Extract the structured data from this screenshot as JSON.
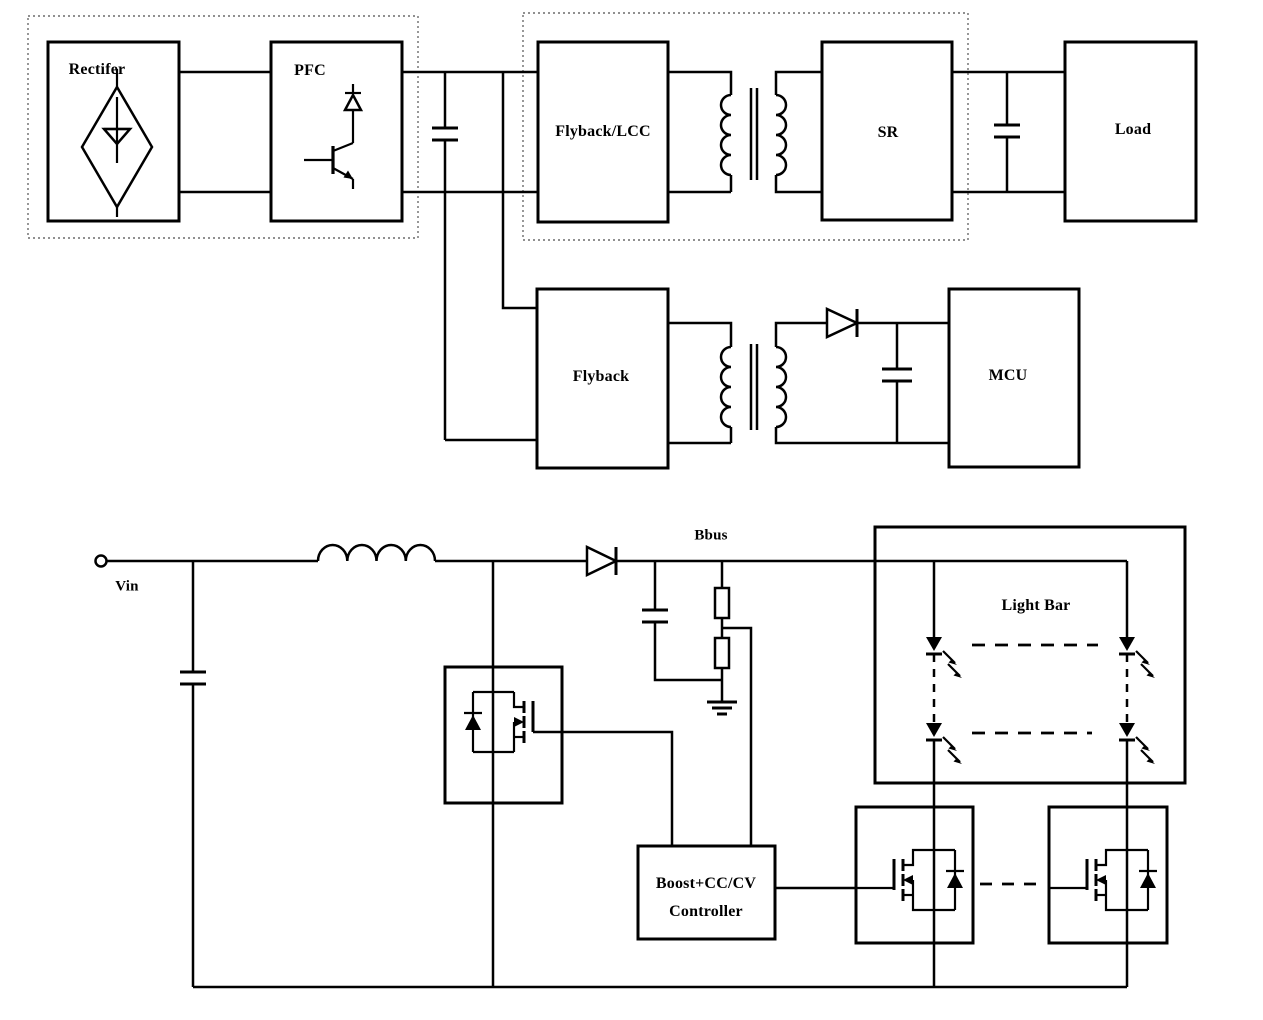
{
  "page": {
    "background": "#ffffff",
    "line_color": "#000000",
    "dotted_border_color": "#6b6b6b"
  },
  "blocks": {
    "rectifier": "Rectifer",
    "pfc": "PFC",
    "flyback_lcc": "Flyback/LCC",
    "sr": "SR",
    "load": "Load",
    "flyback": "Flyback",
    "mcu": "MCU",
    "light_bar": "Light Bar",
    "controller_line1": "Boost+CC/CV",
    "controller_line2": "Controller"
  },
  "nets": {
    "vin": "Vin",
    "bbus": "Bbus"
  }
}
